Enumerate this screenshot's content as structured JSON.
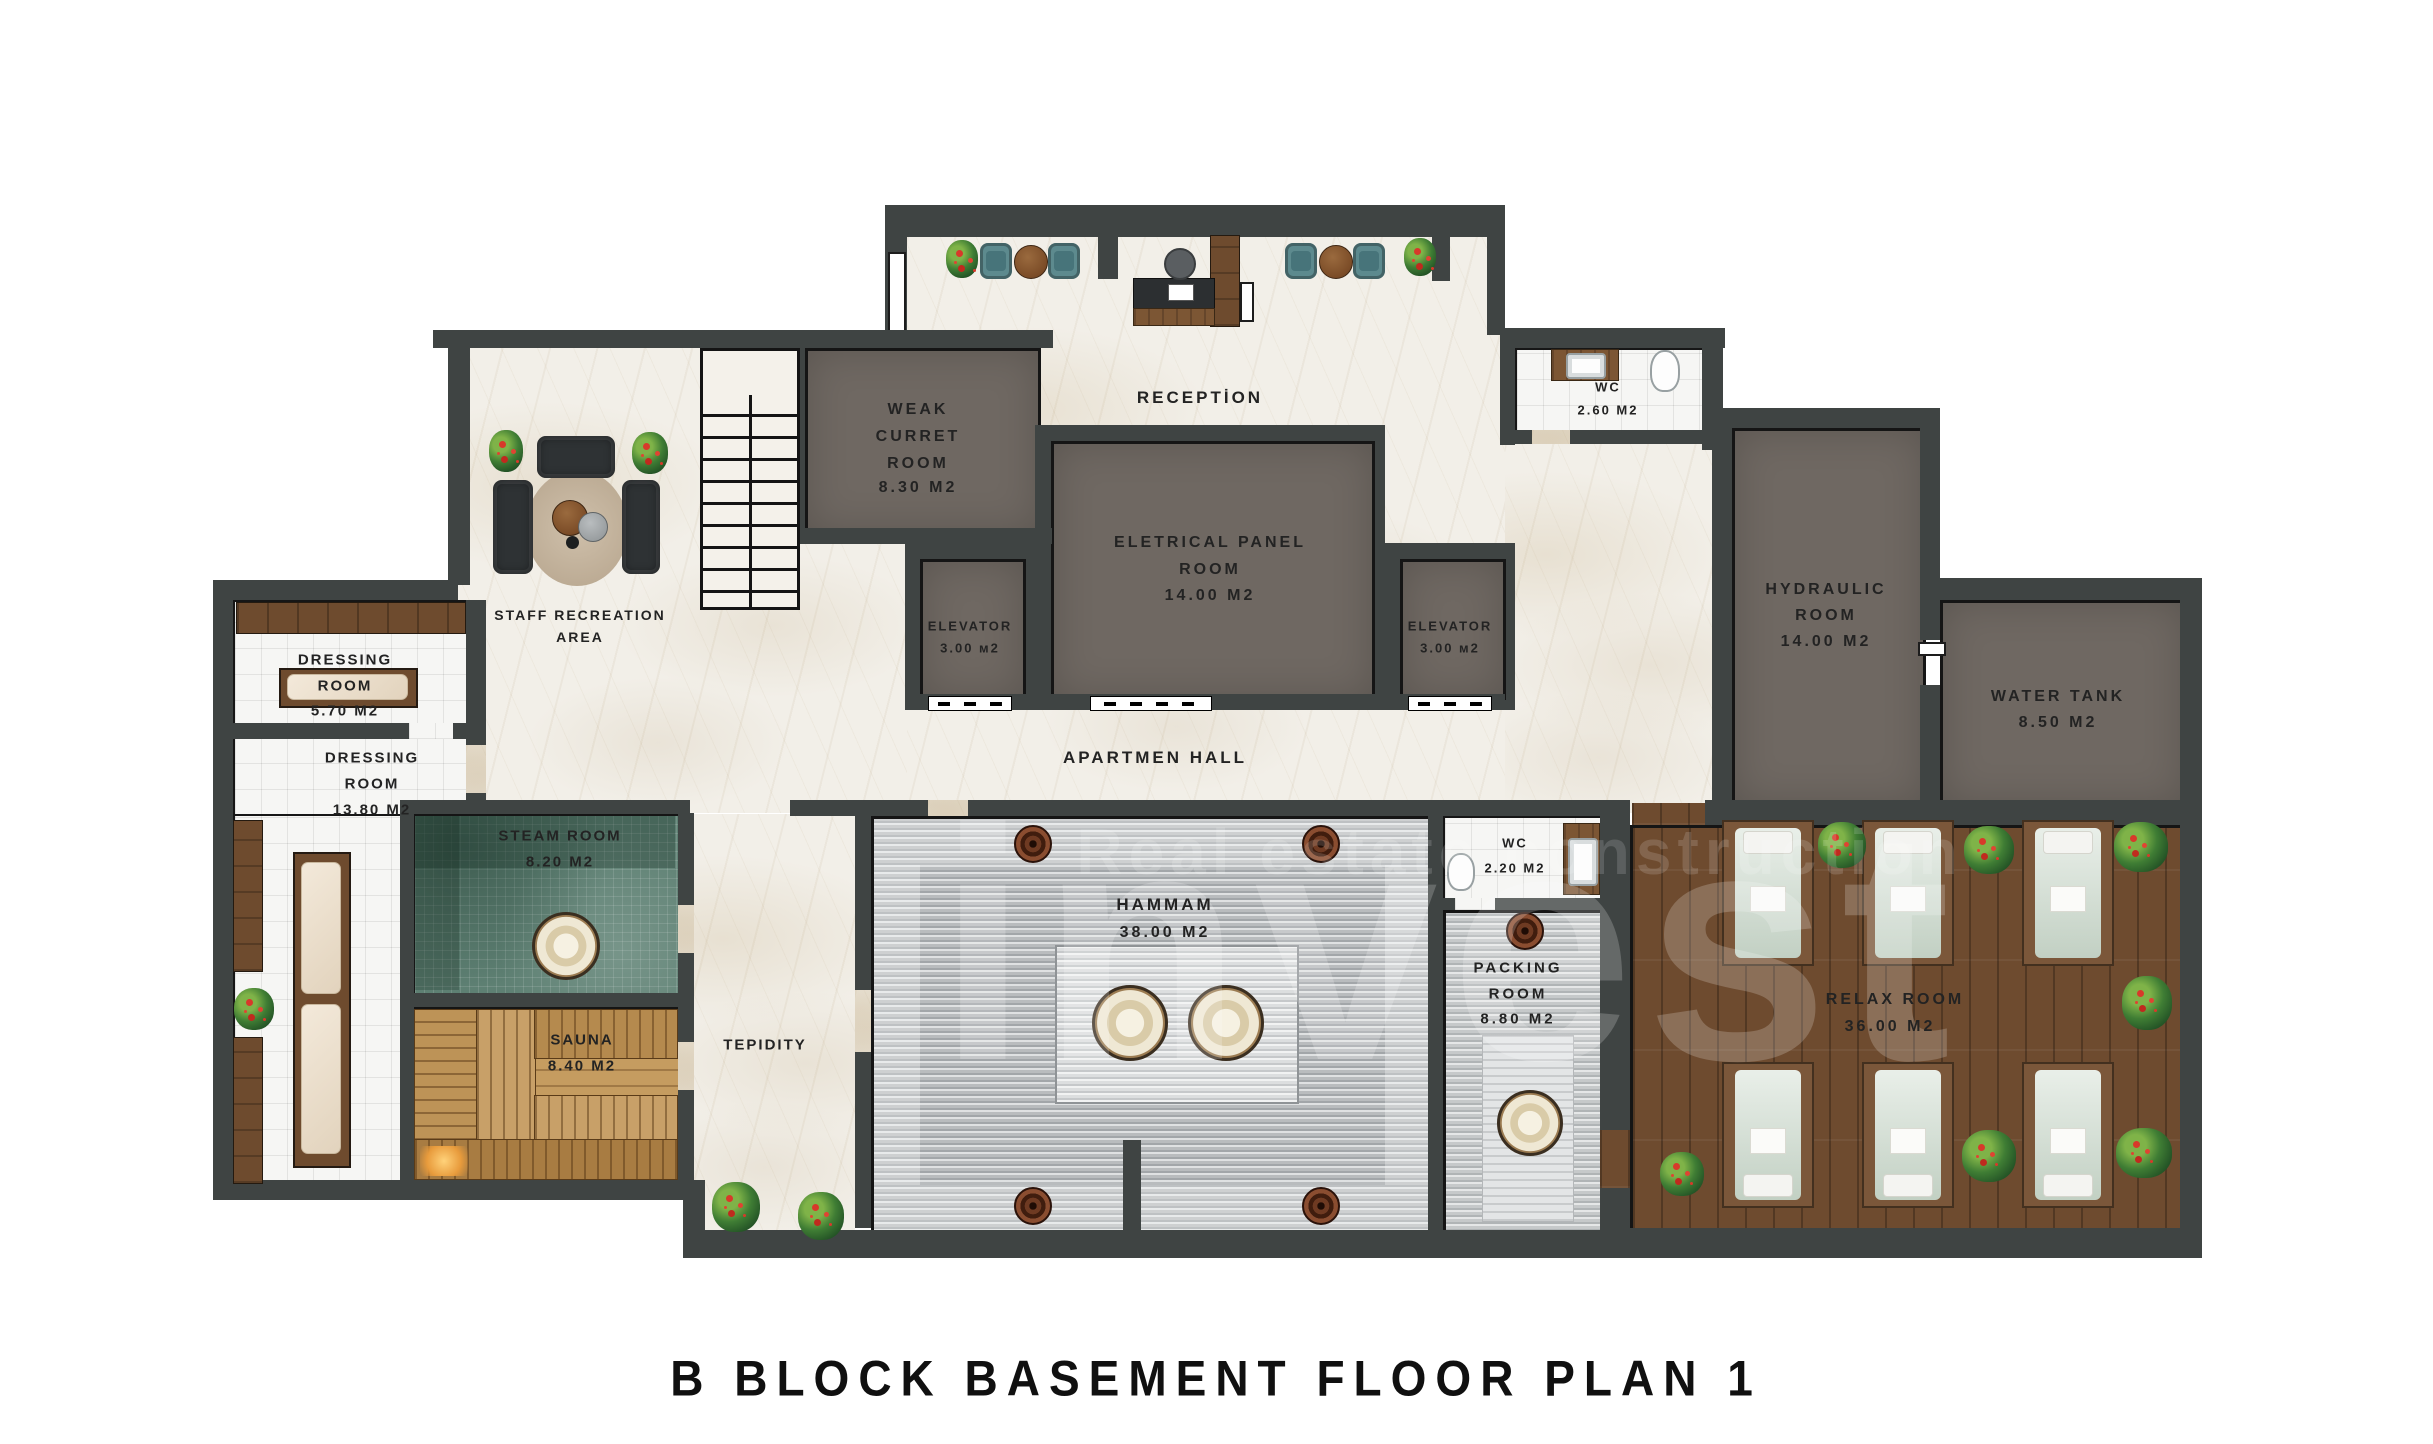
{
  "title": "B  BLOCK  BASEMENT  FLOOR  PLAN  1",
  "watermark": {
    "line1": "invest",
    "line2": "Real estate construction"
  },
  "labels": {
    "reception": "RECEPTİON",
    "wc_top_1": "WC",
    "wc_top_2": "2.60 M2",
    "weak_1": "WEAK",
    "weak_2": "CURRET",
    "weak_3": "ROOM",
    "weak_4": "8.30 M2",
    "elec_1": "ELETRICAL PANEL",
    "elec_2": "ROOM",
    "elec_3": "14.00 M2",
    "elev_left_1": "ELEVATOR",
    "elev_left_2": "3.00 м2",
    "elev_right_1": "ELEVATOR",
    "elev_right_2": "3.00 м2",
    "hyd_1": "HYDRAULIC",
    "hyd_2": "ROOM",
    "hyd_3": "14.00 M2",
    "water_1": "WATER TANK",
    "water_2": "8.50 M2",
    "staff_1": "STAFF RECREATION",
    "staff_2": "AREA",
    "dress_s_1": "DRESSING",
    "dress_s_2": "ROOM",
    "dress_s_3": "5.70 M2",
    "dress_l_1": "DRESSING",
    "dress_l_2": "ROOM",
    "dress_l_3": "13.80 M2",
    "steam_1": "STEAM ROOM",
    "steam_2": "8.20 M2",
    "sauna_1": "SAUNA",
    "sauna_2": "8.40 M2",
    "tepidity": "TEPIDITY",
    "hammam_1": "HAMMAM",
    "hammam_2": "38.00 M2",
    "wc_spa_1": "WC",
    "wc_spa_2": "2.20 M2",
    "pack_1": "PACKING",
    "pack_2": "ROOM",
    "pack_3": "8.80 M2",
    "hall": "APARTMEN HALL",
    "relax_1": "RELAX ROOM",
    "relax_2": "36.00 M2"
  }
}
